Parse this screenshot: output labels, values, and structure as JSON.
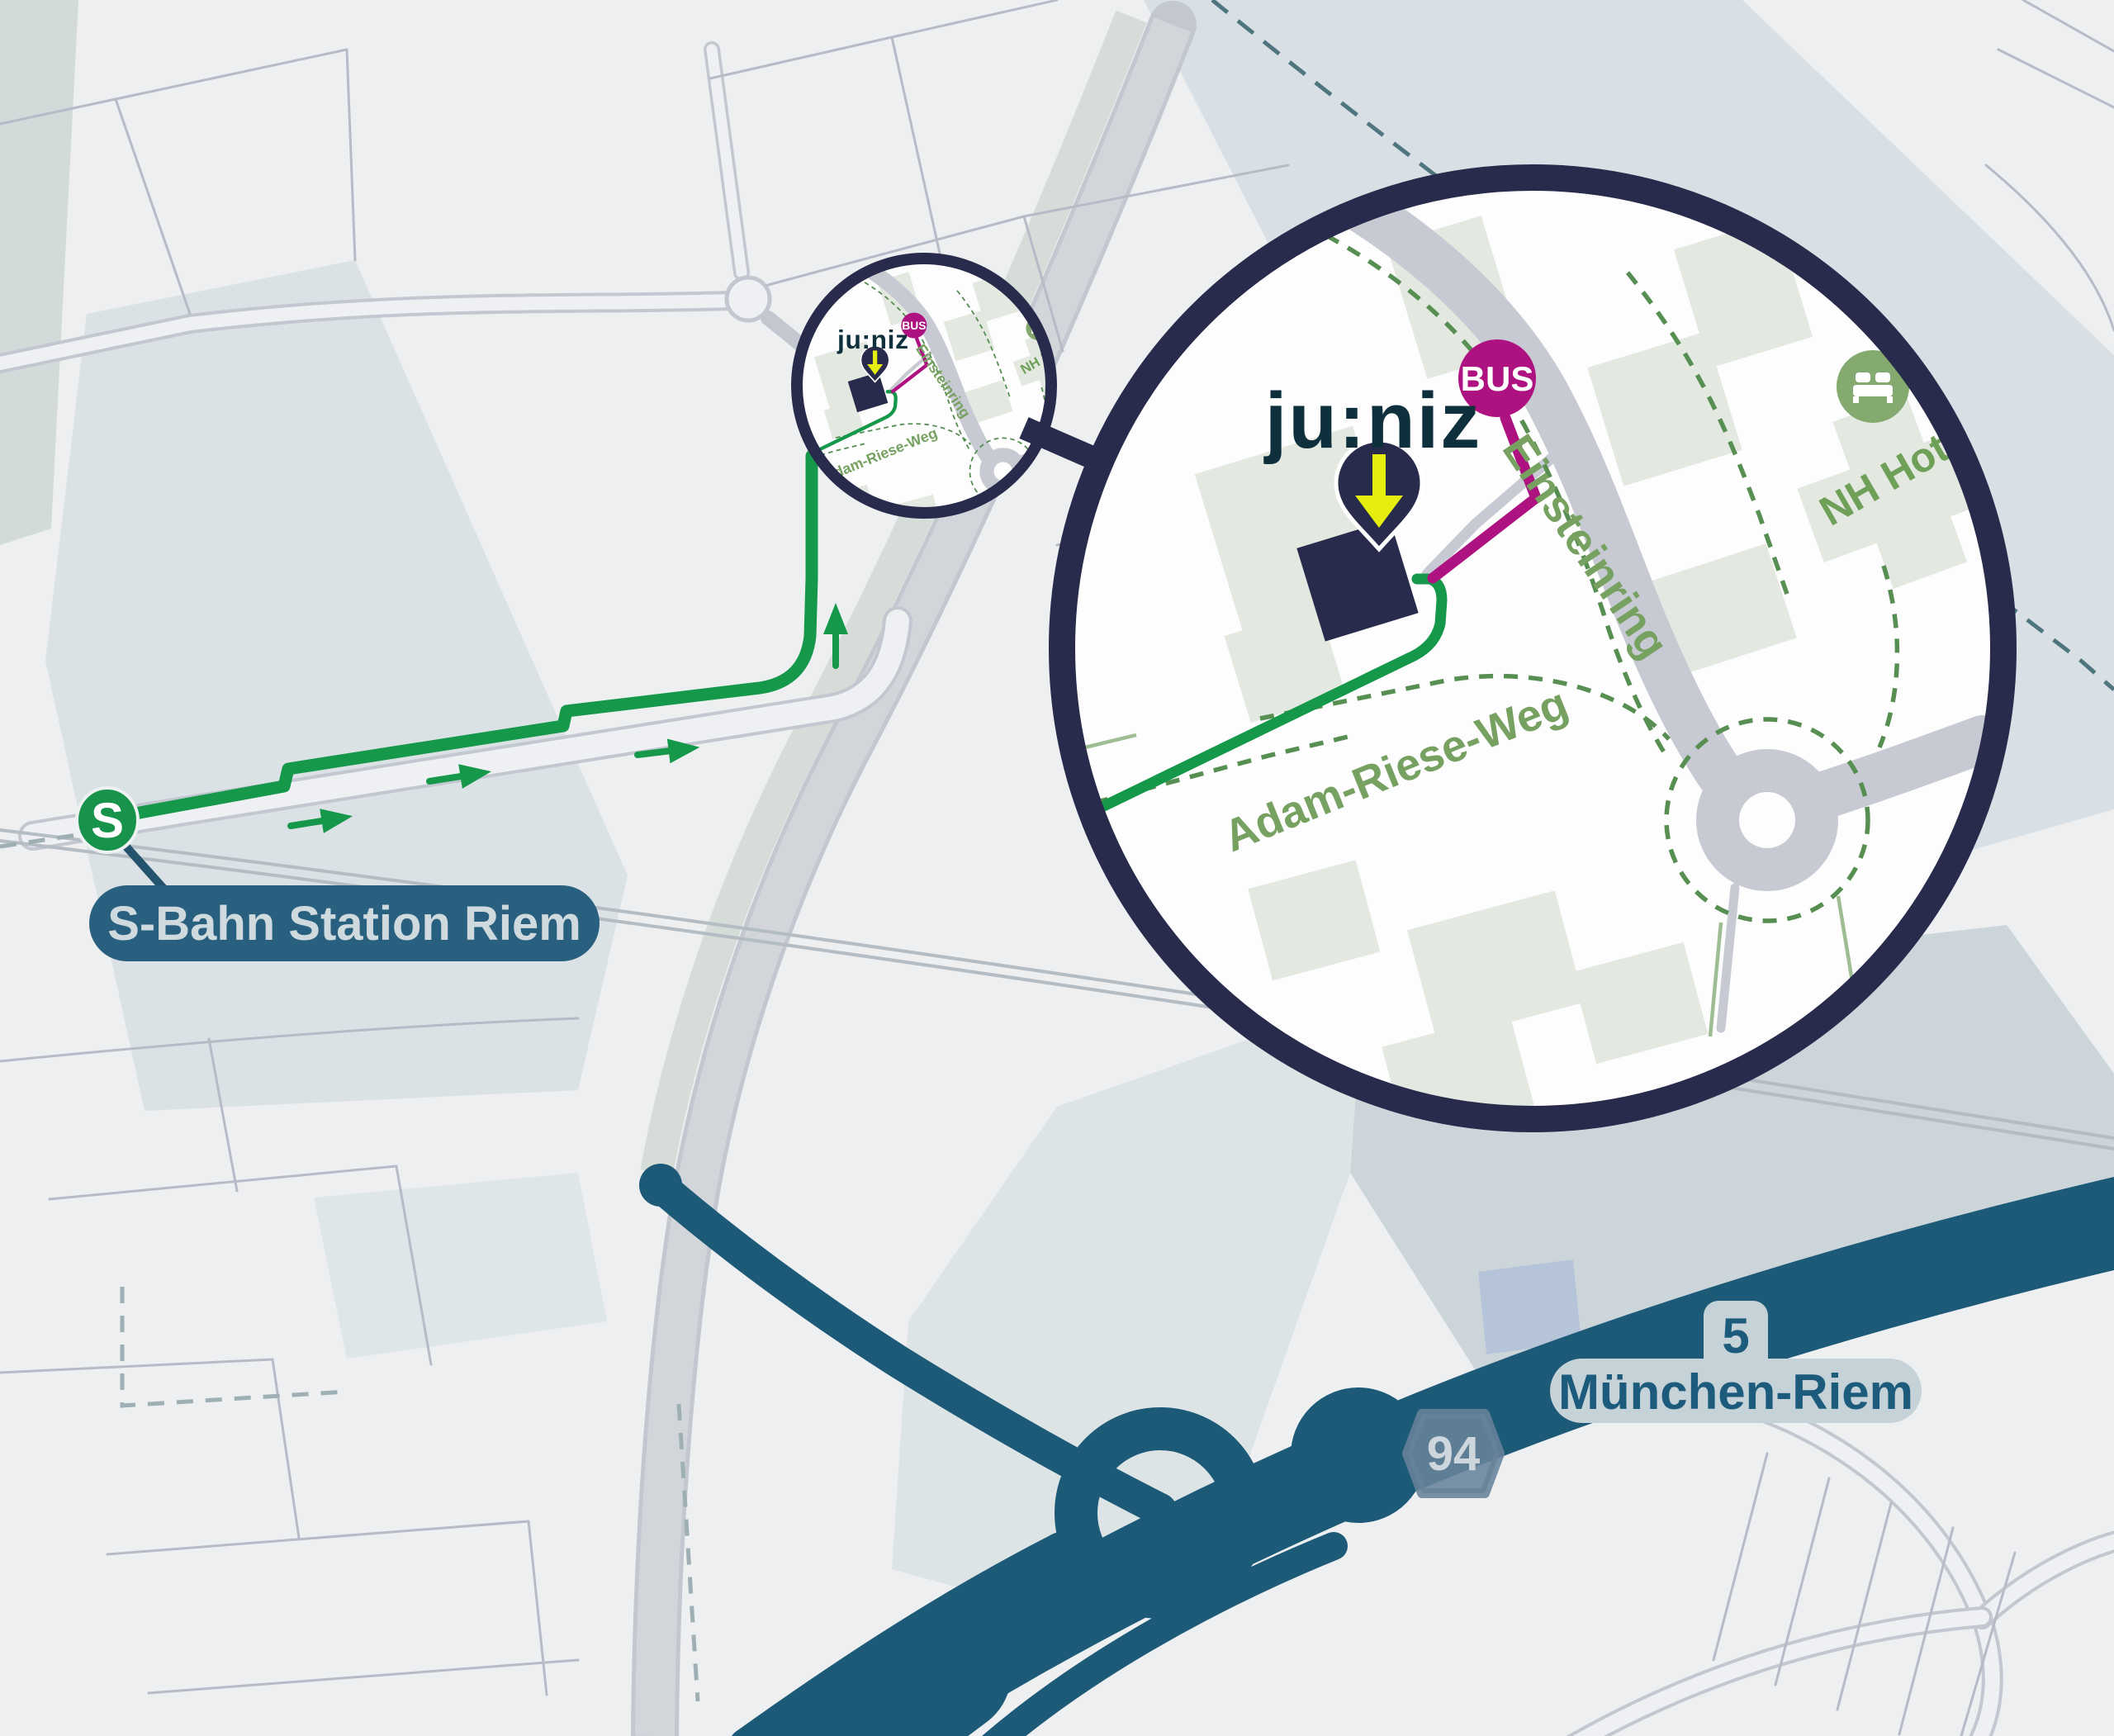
{
  "page": {
    "type": "static-wayfinding-map",
    "language": "de"
  },
  "labels": {
    "station": "S-Bahn Station Riem",
    "s_logo": "S",
    "bus_stop": "BUS",
    "brand": "ju:niz",
    "hotel": "NH Hotel",
    "street_einsteinring": "Einsteinring",
    "street_adam_riese_weg": "Adam-Riese-Weg",
    "motorway_number": "94",
    "exit_number": "5",
    "exit_name": "München-Riem"
  },
  "icons": {
    "s_bahn_logo": "green-circle-white-S",
    "bus_badge": "magenta-circle-BUS",
    "location_pin": "navy-teardrop-pin",
    "down_arrow": "yellow-down-arrow",
    "bed": "white-bed-on-green-circle",
    "route_arrow": "green-direction-arrow",
    "magnifier": "detail-zoom-circles"
  },
  "colors": {
    "map_background": "#edeff1",
    "route_green": "#16984b",
    "s_bahn_green": "#17934b",
    "bus_magenta": "#ae1180",
    "marker_navy": "#282b4b",
    "motorway_teal": "#1d5a78",
    "station_label_bg": "#2a607f",
    "station_label_text": "#cfdade",
    "street_label_green": "#76a161",
    "hotel_green": "#84aa70",
    "badge_94_bg": "#68839a",
    "badge_94_text": "#ccd6dc",
    "exit_label_bg": "#c5d2d8",
    "exit_label_text": "#1d5b7c",
    "brand_text": "#0e2f3c"
  }
}
